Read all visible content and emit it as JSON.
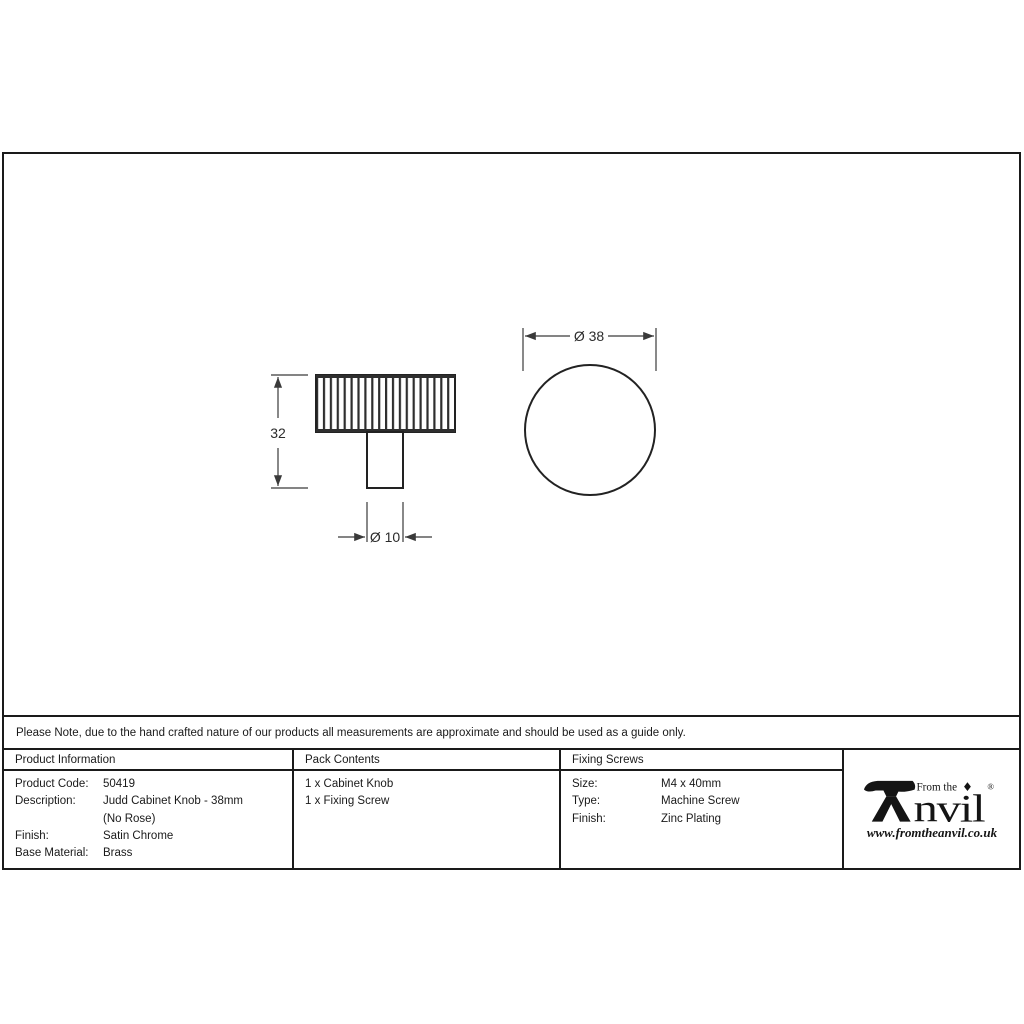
{
  "note_bar": {
    "text": "Please Note, due to the hand crafted nature of our products all measurements are approximate and should be used as a guide only."
  },
  "drawing": {
    "side_view": {
      "height_label": "32",
      "stem_diameter_label": "Ø 10"
    },
    "top_view": {
      "diameter_label": "Ø 38"
    }
  },
  "table": {
    "product_information": {
      "header": "Product Information",
      "rows": [
        {
          "label": "Product Code:",
          "value": "50419"
        },
        {
          "label": "Description:",
          "value": "Judd Cabinet Knob - 38mm"
        },
        {
          "label": "",
          "value": "(No Rose)"
        },
        {
          "label": "Finish:",
          "value": "Satin Chrome"
        },
        {
          "label": "Base Material:",
          "value": "Brass"
        }
      ]
    },
    "pack_contents": {
      "header": "Pack Contents",
      "items": [
        "1 x Cabinet Knob",
        "1 x Fixing Screw"
      ]
    },
    "fixing_screws": {
      "header": "Fixing Screws",
      "rows": [
        {
          "label": "Size:",
          "value": "M4 x 40mm"
        },
        {
          "label": "Type:",
          "value": "Machine Screw"
        },
        {
          "label": "Finish:",
          "value": "Zinc Plating"
        }
      ]
    }
  },
  "logo": {
    "tagline": "From the",
    "brand_suffix": "nvil",
    "registered_mark": "®",
    "website": "www.fromtheanvil.co.uk"
  },
  "colors": {
    "frame_line": "#1a1a1a",
    "drawing_line": "#222222",
    "dimension_line": "#3a3a3a"
  }
}
